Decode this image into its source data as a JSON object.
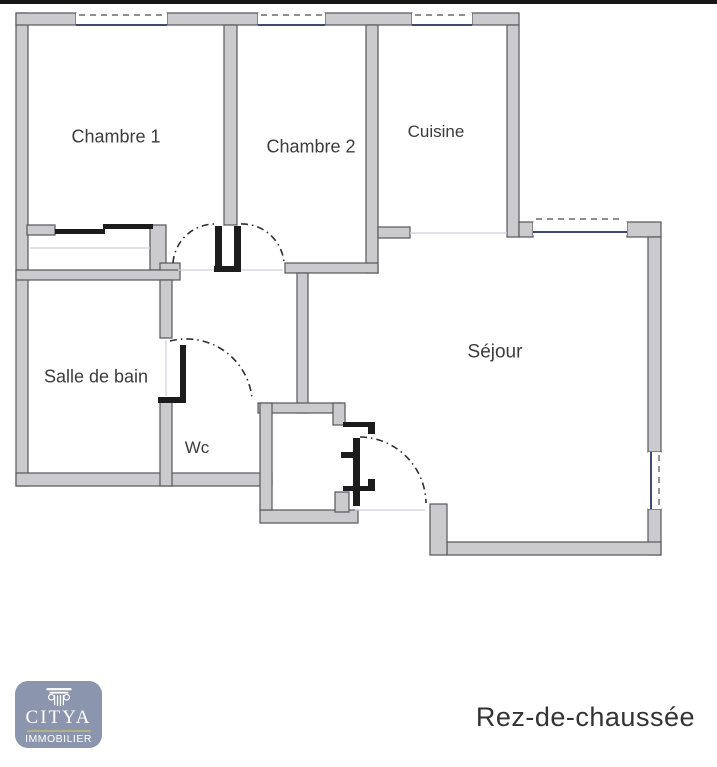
{
  "page": {
    "top_border_color": "#161616",
    "background": "#ffffff"
  },
  "floorplan": {
    "colors": {
      "wall_fill": "#cbcbcd",
      "wall_stroke": "#55555c",
      "window_glass": "#3e4a72",
      "window_dash": "#6a6a6a",
      "door_dark": "#1c1c1c",
      "arc": "#2f2f2f",
      "faint": "#ccd1d9",
      "label": "#3c3c3c"
    },
    "rooms": [
      {
        "id": "chambre-1",
        "label": "Chambre 1",
        "x": 116,
        "y": 136,
        "size": 18
      },
      {
        "id": "chambre-2",
        "label": "Chambre 2",
        "x": 311,
        "y": 146,
        "size": 18
      },
      {
        "id": "cuisine",
        "label": "Cuisine",
        "x": 436,
        "y": 131,
        "size": 17
      },
      {
        "id": "sejour",
        "label": "Séjour",
        "x": 495,
        "y": 351,
        "size": 19
      },
      {
        "id": "salle-de-bain",
        "label": "Salle de bain",
        "x": 96,
        "y": 376,
        "size": 18
      },
      {
        "id": "wc",
        "label": "Wc",
        "x": 197,
        "y": 447,
        "size": 17
      }
    ],
    "walls": [
      [
        16,
        13,
        12,
        473
      ],
      [
        16,
        13,
        60,
        12
      ],
      [
        167,
        13,
        91,
        12
      ],
      [
        325,
        13,
        87,
        12
      ],
      [
        472,
        13,
        47,
        12
      ],
      [
        507,
        25,
        12,
        212
      ],
      [
        519,
        222,
        14,
        15
      ],
      [
        627,
        222,
        34,
        15
      ],
      [
        648,
        237,
        13,
        215
      ],
      [
        648,
        509,
        13,
        46
      ],
      [
        447,
        542,
        214,
        13
      ],
      [
        430,
        504,
        17,
        51
      ],
      [
        260,
        510,
        98,
        13
      ],
      [
        16,
        473,
        256,
        13
      ],
      [
        27,
        225,
        28,
        10
      ],
      [
        150,
        225,
        16,
        45
      ],
      [
        224,
        25,
        13,
        200
      ],
      [
        366,
        25,
        12,
        248
      ],
      [
        285,
        263,
        93,
        10
      ],
      [
        160,
        263,
        20,
        10
      ],
      [
        16,
        270,
        164,
        10
      ],
      [
        160,
        280,
        12,
        58
      ],
      [
        160,
        398,
        12,
        88
      ],
      [
        378,
        227,
        32,
        11
      ],
      [
        297,
        273,
        11,
        140
      ],
      [
        258,
        403,
        84,
        10
      ],
      [
        333,
        403,
        12,
        22
      ],
      [
        260,
        403,
        12,
        107
      ],
      [
        335,
        492,
        14,
        20
      ]
    ],
    "dark_elements": [
      [
        55,
        229,
        50,
        5
      ],
      [
        103,
        224,
        50,
        5
      ],
      [
        215,
        226,
        7,
        41
      ],
      [
        234,
        226,
        7,
        41
      ],
      [
        214,
        266,
        27,
        6
      ],
      [
        158,
        397,
        28,
        6
      ],
      [
        180,
        345,
        6,
        56
      ],
      [
        353,
        438,
        7,
        68
      ],
      [
        341,
        452,
        12,
        6
      ],
      [
        343,
        422,
        32,
        5
      ],
      [
        368,
        425,
        7,
        9
      ],
      [
        343,
        486,
        32,
        5
      ],
      [
        368,
        479,
        7,
        8
      ]
    ],
    "door_arcs": [
      "M173 263 A42 42 0 0 1 215 224",
      "M241 224 A42 42 0 0 1 284 263",
      "M170 341 A66 66 0 0 1 252 398",
      "M360 437 A67 67 0 0 1 426 503"
    ],
    "windows": [
      {
        "rect": [
          76,
          13,
          91,
          12
        ],
        "glass": [
          76,
          25,
          167,
          25
        ],
        "dash": [
          79,
          15,
          164,
          15
        ]
      },
      {
        "rect": [
          258,
          13,
          67,
          12
        ],
        "glass": [
          258,
          25,
          325,
          25
        ],
        "dash": [
          261,
          15,
          322,
          15
        ]
      },
      {
        "rect": [
          412,
          13,
          60,
          12
        ],
        "glass": [
          412,
          25,
          472,
          25
        ],
        "dash": [
          415,
          15,
          469,
          15
        ]
      },
      {
        "rect": [
          533,
          222,
          94,
          13
        ],
        "glass": [
          533,
          232,
          627,
          232
        ],
        "dash": [
          536,
          219,
          624,
          219
        ]
      },
      {
        "rect": [
          648,
          452,
          13,
          57
        ],
        "glass": [
          651,
          452,
          651,
          509
        ],
        "dash": [
          659,
          455,
          659,
          506
        ]
      }
    ],
    "faint_lines": [
      [
        178,
        270,
        283,
        270
      ],
      [
        410,
        233,
        507,
        233
      ],
      [
        355,
        510,
        425,
        510
      ],
      [
        166,
        340,
        166,
        396
      ],
      [
        30,
        248,
        150,
        248
      ]
    ]
  },
  "footer": {
    "floor_label": "Rez-de-chaussée"
  },
  "logo": {
    "brand": "CITYA",
    "tagline": "IMMOBILIER",
    "icon": "column-capital-icon",
    "background": "#8b95ad",
    "divider_color": "#b1b184",
    "text_color": "#ffffff"
  }
}
